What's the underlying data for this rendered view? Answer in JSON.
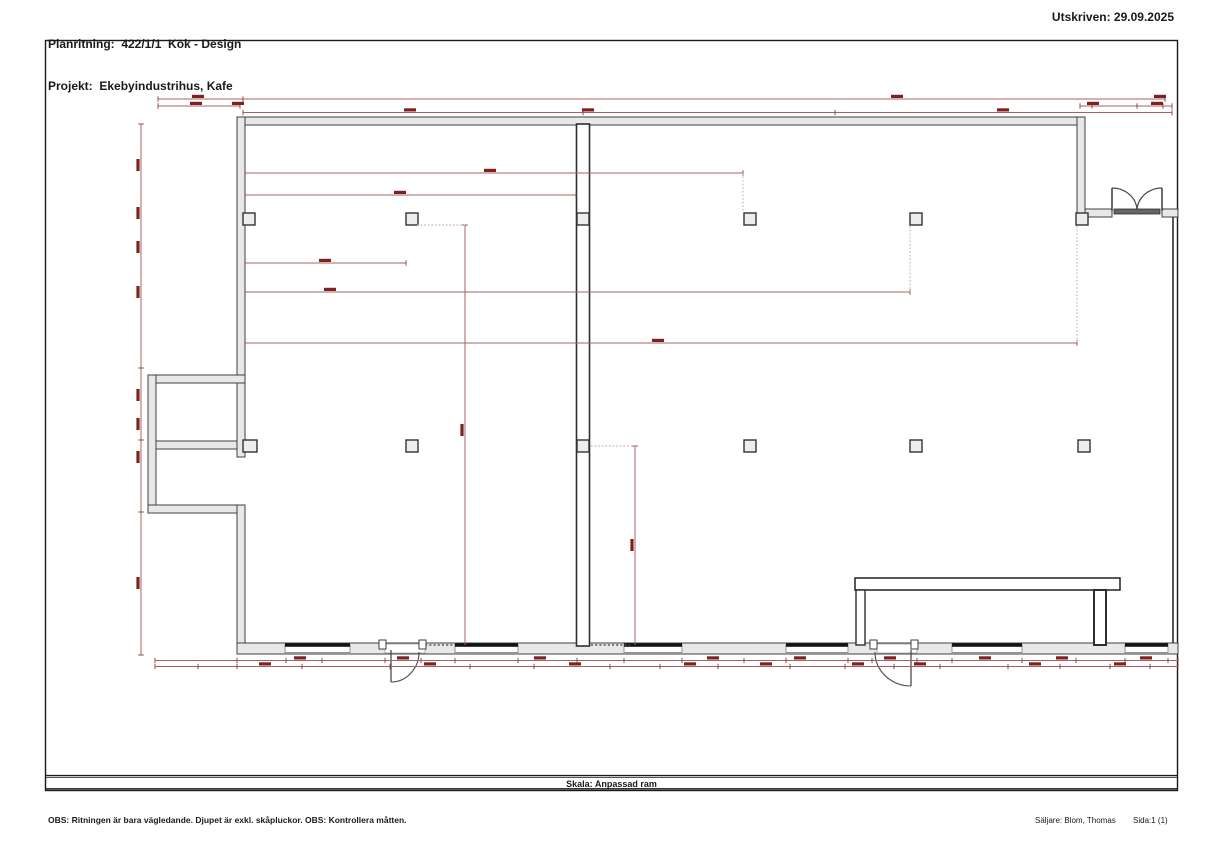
{
  "header": {
    "line1": "Planritning:  422/1/1  Kök - Design",
    "line2": "Projekt:  Ekebyindustrihus, Kafe",
    "printed": "Utskriven: 29.09.2025"
  },
  "footer": {
    "scale": "Skala: Anpassad ram",
    "note": "OBS: Ritningen är bara vägledande. Djupet är exkl. skåpluckor. OBS: Kontrollera måtten.",
    "seller": "Säljare: Blom, Thomas",
    "page": "Sida:1 (1)"
  },
  "colors": {
    "wall_fill": "#e8e8e8",
    "wall_stroke": "#3f3f3f",
    "heavy": "#1c1c1c",
    "line_mid": "#2e2e2e",
    "window_bar": "#141414",
    "door": "#4a4a4a",
    "door_bar": "#666666",
    "frame": "#1a1a1a",
    "dim_line": "#a86060",
    "dim_tick": "#8f3a3a",
    "dim_label": "#7c2222",
    "dim_dotted": "#c49a9a",
    "wall_dotted": "#555555"
  },
  "plan": {
    "frame": {
      "x": 45.5,
      "y": 40.5,
      "w": 1132,
      "h": 750,
      "band_lines": [
        775.5,
        777.3,
        788.8
      ]
    },
    "walls": [
      [
        237,
        117,
        848,
        8
      ],
      [
        237,
        117,
        8,
        266
      ],
      [
        148,
        375,
        97,
        8
      ],
      [
        148,
        375,
        8,
        138
      ],
      [
        148,
        505,
        97,
        8
      ],
      [
        156,
        441,
        88,
        8
      ],
      [
        237,
        383,
        8,
        74
      ],
      [
        237,
        505,
        8,
        148
      ],
      [
        237,
        643,
        941,
        11
      ],
      [
        1077,
        117,
        8,
        100
      ],
      [
        1085,
        209,
        27,
        8
      ],
      [
        1162,
        209,
        16,
        8
      ]
    ],
    "right_line": {
      "x": 1173,
      "y1": 217,
      "y2": 643
    },
    "central_wall": {
      "x": 576.5,
      "y": 124,
      "w": 13,
      "h": 522
    },
    "windows": [
      [
        285,
        350
      ],
      [
        455,
        518
      ],
      [
        624,
        682
      ],
      [
        786,
        848
      ],
      [
        952,
        1022
      ],
      [
        1125,
        1168
      ]
    ],
    "wall_dotted_segs": [
      [
        421,
        455,
        645
      ],
      [
        591,
        630,
        645
      ]
    ],
    "door_openings": [
      [
        385,
        644,
        40,
        9
      ],
      [
        877,
        644,
        40,
        9
      ]
    ],
    "door_jambs": [
      [
        379,
        640,
        7,
        9
      ],
      [
        419,
        640,
        7,
        9
      ],
      [
        870,
        640,
        7,
        9
      ],
      [
        911,
        640,
        7,
        9
      ]
    ],
    "door_leaves": [
      {
        "line": [
          391,
          650,
          391,
          682
        ],
        "arc": "M 419 652 A 28 30 0 0 1 391 682"
      },
      {
        "line": [
          911,
          650,
          911,
          686
        ],
        "arc": "M 875 652 A 36 34 0 0 0 911 686"
      }
    ],
    "double_door": {
      "leaf_lines": [
        [
          1112,
          188,
          1112,
          211
        ],
        [
          1162,
          188,
          1162,
          211
        ]
      ],
      "arcs": [
        "M 1112 188 A 25 23 0 0 1 1137 211",
        "M 1162 188 A 25 23 0 0 0 1137 211"
      ],
      "bar": [
        1114,
        209,
        46,
        5
      ]
    },
    "columns": [
      [
        243,
        213,
        12,
        12
      ],
      [
        406,
        213,
        12,
        12
      ],
      [
        577,
        213,
        12,
        12
      ],
      [
        744,
        213,
        12,
        12
      ],
      [
        910,
        213,
        12,
        12
      ],
      [
        1076,
        213,
        12,
        12
      ],
      [
        406,
        440,
        12,
        12
      ],
      [
        577,
        440,
        12,
        12
      ],
      [
        744,
        440,
        12,
        12
      ],
      [
        910,
        440,
        12,
        12
      ],
      [
        1078,
        440,
        12,
        12
      ],
      [
        243,
        440,
        14,
        12
      ]
    ],
    "counter": {
      "bar": [
        855,
        578,
        265,
        12
      ],
      "leg_left": [
        856,
        590,
        9,
        55
      ],
      "leg_right": [
        1094,
        590,
        12,
        55
      ]
    },
    "top_dims": [
      {
        "y": 99,
        "segs": [
          [
            158,
            243
          ],
          [
            243,
            1165
          ]
        ],
        "ticks": [
          158,
          243,
          1165
        ],
        "labels": [
          198,
          897,
          1160
        ]
      },
      {
        "y": 106,
        "segs": [
          [
            158,
            240
          ],
          [
            1080,
            1172
          ]
        ],
        "ticks": [
          158,
          240,
          1080,
          1092,
          1137,
          1163,
          1172
        ],
        "labels": [
          196,
          238,
          1093,
          1157
        ]
      },
      {
        "y": 112.5,
        "segs": [
          [
            243,
            1172
          ]
        ],
        "ticks": [
          243,
          583,
          835,
          1172
        ],
        "labels": [
          410,
          588,
          1003
        ]
      }
    ],
    "left_dim": {
      "x": 141,
      "y1": 124,
      "y2": 655,
      "ticks": [
        124,
        368,
        440,
        512,
        655
      ],
      "labels": [
        165,
        213,
        247,
        292,
        395,
        424,
        457,
        583
      ]
    },
    "bottom_dims": [
      {
        "y": 660.5,
        "x1": 155,
        "x2": 1178,
        "ticks": [
          155,
          237,
          286,
          322,
          385,
          421,
          455,
          518,
          577,
          624,
          682,
          744,
          786,
          848,
          872,
          917,
          952,
          1022,
          1076,
          1125,
          1168,
          1178
        ],
        "labels": [
          300,
          403,
          540,
          713,
          800,
          890,
          985,
          1062,
          1146
        ]
      },
      {
        "y": 666.5,
        "x1": 155,
        "x2": 1178,
        "ticks": [
          155,
          198,
          237,
          302,
          390,
          470,
          534,
          610,
          660,
          718,
          790,
          845,
          894,
          940,
          1008,
          1060,
          1110,
          1150,
          1178
        ],
        "labels": [
          265,
          430,
          575,
          690,
          766,
          858,
          920,
          1035,
          1120
        ]
      }
    ],
    "interior_h": [
      {
        "y": 173,
        "x1": 245,
        "x2": 743,
        "label_x": 490,
        "vdot": [
          743,
          173,
          213
        ]
      },
      {
        "y": 195,
        "x1": 245,
        "x2": 576,
        "label_x": 400
      },
      {
        "y": 263,
        "x1": 245,
        "x2": 406,
        "label_x": 325
      },
      {
        "y": 292,
        "x1": 245,
        "x2": 910,
        "label_x": 330,
        "vdot": [
          910,
          226,
          292
        ]
      },
      {
        "y": 343,
        "x1": 245,
        "x2": 1077,
        "label_x": 658,
        "vdot": [
          1077,
          226,
          343
        ]
      }
    ],
    "interior_v": [
      {
        "x": 465,
        "y1": 225,
        "y2": 645,
        "label_y": 430,
        "hdot": [
          417,
          465,
          225
        ]
      },
      {
        "x": 635,
        "y1": 446,
        "y2": 645,
        "label_y": 545,
        "hdot": [
          591,
          635,
          446
        ]
      }
    ]
  }
}
